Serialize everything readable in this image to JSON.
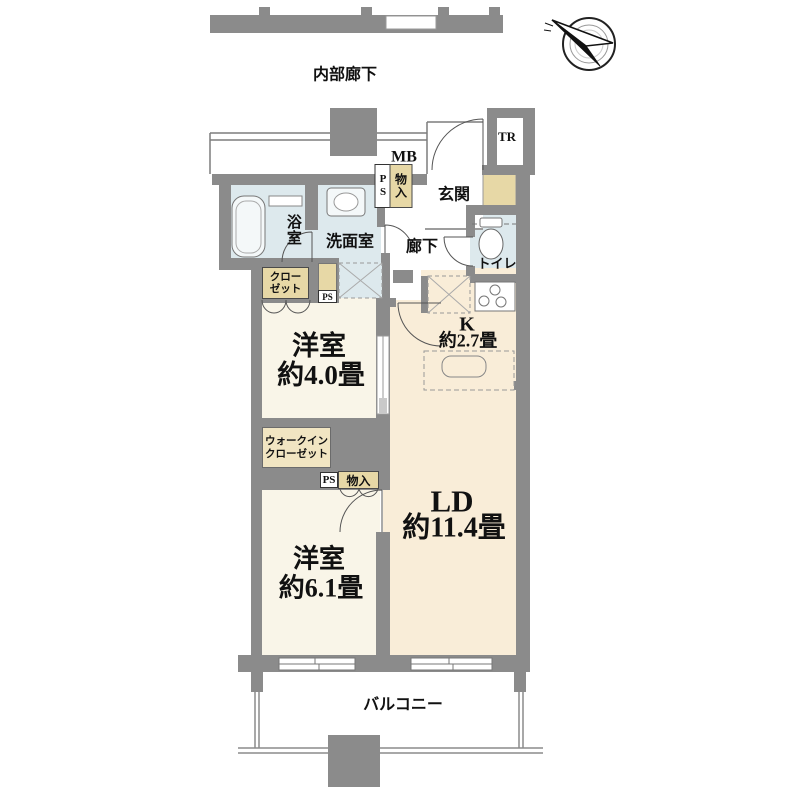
{
  "palette": {
    "wall": "#8b8b8b",
    "wet": "#dde9ed",
    "tan": "#e7d8a6",
    "tan_light": "#f1e5c2",
    "cream": "#f9edd8",
    "room": "#f9f5e8",
    "ink": "#111111"
  },
  "labels": {
    "corridor": "内部廊下",
    "mb": "MB",
    "tr": "TR",
    "entrance": "玄関",
    "ps": "PS",
    "storage": "物入",
    "bathroom": "浴室",
    "washroom": "洗面室",
    "hallway": "廊下",
    "toilet": "トイレ",
    "closet_line1": "クロー",
    "closet_line2": "ゼット",
    "kitchen": "K",
    "kitchen_size": "約2.7畳",
    "bedroom1": "洋室",
    "bedroom1_size": "約4.0畳",
    "wic_line1": "ウォークイン",
    "wic_line2": "クローゼット",
    "ps_lower": "PS",
    "storage_lower": "物入",
    "living_dining": "LD",
    "living_dining_size": "約11.4畳",
    "bedroom2": "洋室",
    "bedroom2_size": "約6.1畳",
    "balcony": "バルコニー"
  }
}
